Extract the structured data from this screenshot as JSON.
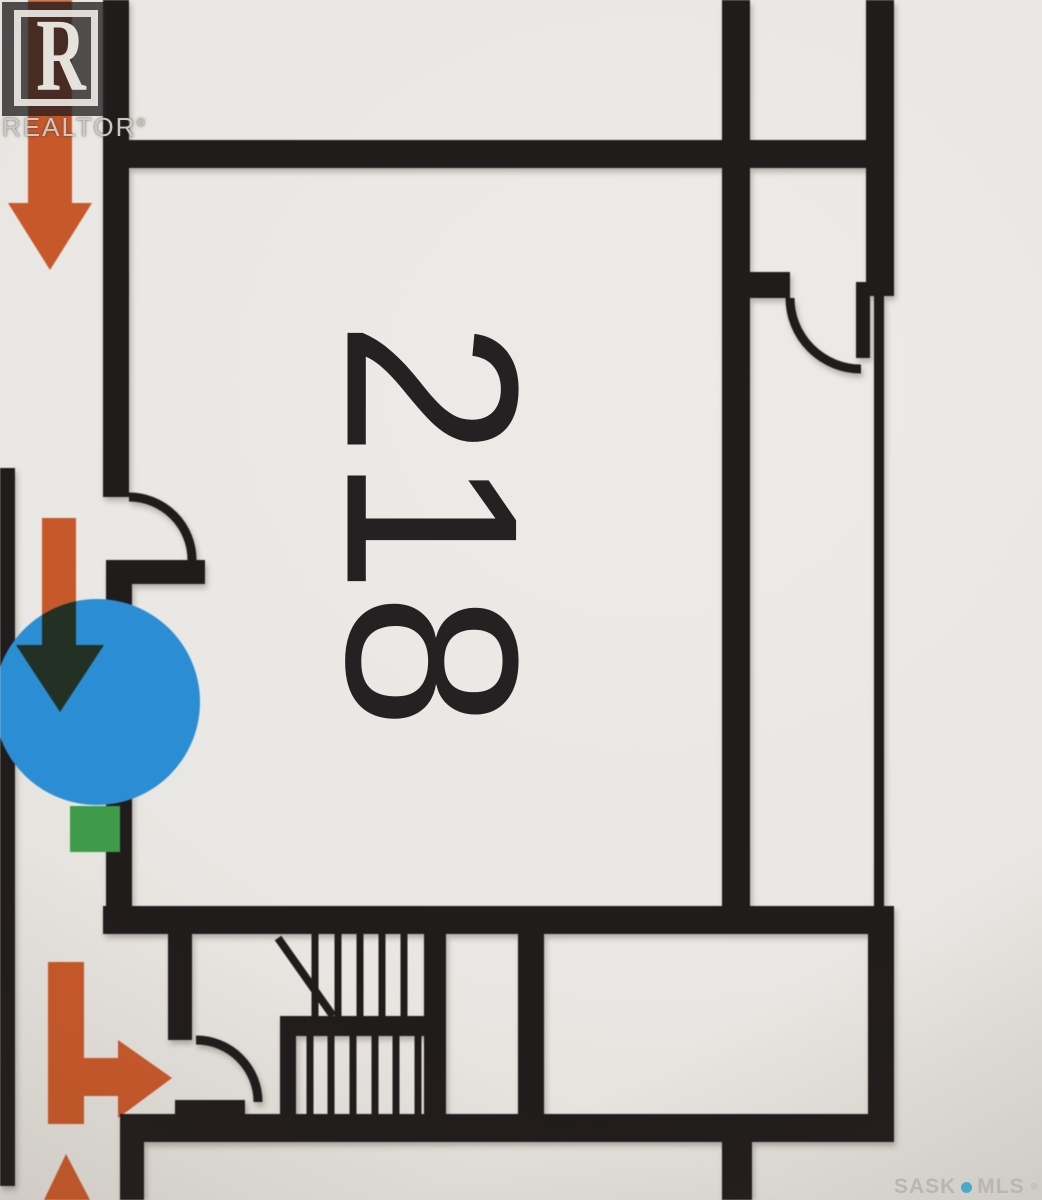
{
  "canvas": {
    "width": 1042,
    "height": 1200
  },
  "colors": {
    "paper": "#e9e7e3",
    "wall": "#211c1c",
    "arrow_orange": "#c7582a",
    "marker_blue": "#2b8ed4",
    "marker_green": "#3f9b4a",
    "mls_dot_blue": "#4aa9c9",
    "watermark_gray": "#bab6af"
  },
  "plan": {
    "room_label": "218",
    "walls": [
      {
        "name": "left-edge-wall",
        "x": 0,
        "y": 468,
        "w": 15,
        "h": 718
      },
      {
        "name": "room218-left-wall-upper",
        "x": 103,
        "y": 0,
        "w": 26,
        "h": 497
      },
      {
        "name": "room218-left-jog-wall",
        "x": 106,
        "y": 560,
        "w": 99,
        "h": 24
      },
      {
        "name": "room218-left-wall-lower",
        "x": 106,
        "y": 584,
        "w": 26,
        "h": 350
      },
      {
        "name": "room218-top-wall",
        "x": 103,
        "y": 140,
        "w": 791,
        "h": 28
      },
      {
        "name": "room218-right-wall",
        "x": 722,
        "y": 0,
        "w": 28,
        "h": 934
      },
      {
        "name": "ne-corridor-right-wall",
        "x": 866,
        "y": 0,
        "w": 28,
        "h": 296
      },
      {
        "name": "ne-door-stub",
        "x": 748,
        "y": 272,
        "w": 42,
        "h": 26
      },
      {
        "name": "ne-door-leaf",
        "x": 856,
        "y": 282,
        "w": 14,
        "h": 76
      },
      {
        "name": "room218-bottom-wall",
        "x": 103,
        "y": 906,
        "w": 791,
        "h": 28
      },
      {
        "name": "stair-corridor-left-wall",
        "x": 168,
        "y": 934,
        "w": 24,
        "h": 106
      },
      {
        "name": "stairwell-right-wall",
        "x": 424,
        "y": 934,
        "w": 22,
        "h": 180
      },
      {
        "name": "small-room-right-wall",
        "x": 518,
        "y": 934,
        "w": 26,
        "h": 180
      },
      {
        "name": "right-wall-lower",
        "x": 868,
        "y": 906,
        "w": 26,
        "h": 236
      },
      {
        "name": "stair-mid-divider",
        "x": 282,
        "y": 1016,
        "w": 148,
        "h": 20
      },
      {
        "name": "lower-flight-left-wall",
        "x": 280,
        "y": 1016,
        "w": 16,
        "h": 126
      },
      {
        "name": "bottom-wall",
        "x": 120,
        "y": 1114,
        "w": 774,
        "h": 28
      },
      {
        "name": "stair-door-stub",
        "x": 175,
        "y": 1100,
        "w": 70,
        "h": 14
      },
      {
        "name": "left-bottom-wall",
        "x": 120,
        "y": 1142,
        "w": 24,
        "h": 58
      },
      {
        "name": "bottom-center-wall-stub",
        "x": 722,
        "y": 1142,
        "w": 30,
        "h": 58
      }
    ],
    "thin_walls": [
      {
        "name": "ne-thin-partition",
        "x": 874,
        "y": 296,
        "w": 10,
        "h": 610
      }
    ],
    "door_arcs": [
      {
        "name": "room218-west-door-arc",
        "d": "M 129 497 A 63 63 0 0 1 192 560"
      },
      {
        "name": "ne-door-arc",
        "d": "M 790 298 A 71 71 0 0 0 861 369"
      },
      {
        "name": "stair-door-arc",
        "d": "M 196 1040 A 62 62 0 0 1 258 1102"
      }
    ],
    "stairs": {
      "upper_treads": {
        "xs": [
          315,
          338,
          360,
          382,
          404
        ],
        "y1": 934,
        "y2": 1016
      },
      "lower_treads": {
        "xs": [
          310,
          331,
          353,
          375,
          396,
          418
        ],
        "y1": 1036,
        "y2": 1114
      },
      "diagonal": {
        "x1": 278,
        "y1": 938,
        "x2": 333,
        "y2": 1016
      },
      "tread_width": 7
    },
    "markers": {
      "blue_circle": {
        "cx": 97,
        "cy": 702,
        "r": 103
      },
      "green_square": {
        "x": 70,
        "y": 806,
        "w": 50,
        "h": 46
      }
    },
    "arrows": [
      {
        "name": "arrow-down-top",
        "points": "28,0 72,0 72,203 92,203 50,270 8,203 28,203"
      },
      {
        "name": "arrow-down-middle",
        "points": "42,518 76,518 76,645 104,645 60,712 16,645 42,645"
      },
      {
        "name": "arrow-down-right-bottom",
        "points": "48,962 84,962 84,1058 118,1058 118,1040 172,1078 118,1118 118,1096 84,1096 84,1124 48,1124"
      },
      {
        "name": "arrow-partial-bottom-edge",
        "points": "66,1154 90,1200 44,1200"
      }
    ]
  },
  "watermarks": {
    "realtor": {
      "r_glyph": "R",
      "label": "REALTOR",
      "reg": "®"
    },
    "sask_mls": {
      "part1": "SASK",
      "part2": "MLS",
      "reg": "®"
    }
  }
}
